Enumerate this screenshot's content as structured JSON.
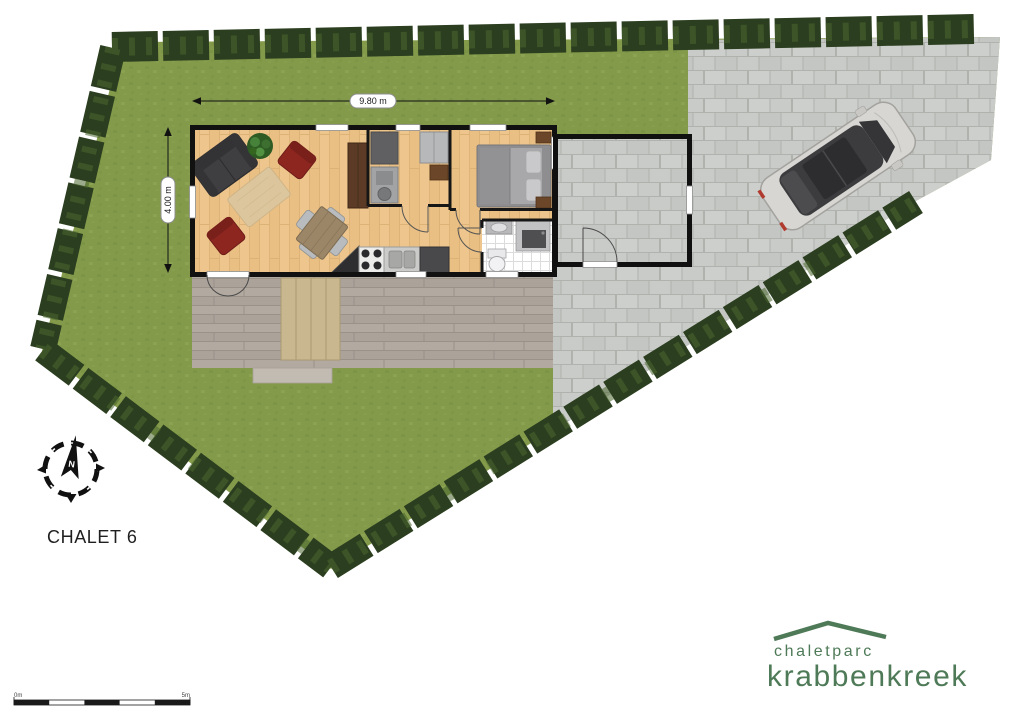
{
  "plan": {
    "title": "CHALET 6",
    "dim_width": "9.80 m",
    "dim_height": "4.00 m"
  },
  "compass": {
    "north": "N"
  },
  "scalebar": {
    "zero": "0m",
    "five": "5m"
  },
  "logo": {
    "line1": "chaletparc",
    "line2": "krabbenkreek",
    "color": "#4e7a57"
  },
  "colors": {
    "grass": "#839a4b",
    "grass_dark": "#7b9243",
    "grass_light": "#8ea654",
    "hedge": "#2b3e1f",
    "hedge_light": "#4a672e",
    "pavement": "#c9cbc8",
    "pavement_joint": "#b0b2ae",
    "decking": "#b2a9a0",
    "decking_joint": "#9a9289",
    "terrace_table": "#c9b88f",
    "wood_floor": "#eec68d",
    "wall": "#111111",
    "window": "#ffffff",
    "sofa": "#3f3f42",
    "armchair": "#8e2620",
    "rug": "#dcc69e",
    "dining_table": "#9b8668",
    "chair": "#b9bcbe",
    "tv_cabinet": "#5b3a26",
    "plant": "#35661f",
    "bed_mattress": "#a8a8aa",
    "bed_frame": "#8e8e90",
    "pillow": "#c9c9cb",
    "nightstand": "#6b4629",
    "appliance": "#a2a3a5",
    "appliance_dark": "#606063",
    "fridge": "#49494b",
    "tile_grout": "#dcdcdc",
    "car_body": "#d7d6d2",
    "car_glass": "#3c3c3f",
    "dimension_line": "#111111"
  }
}
